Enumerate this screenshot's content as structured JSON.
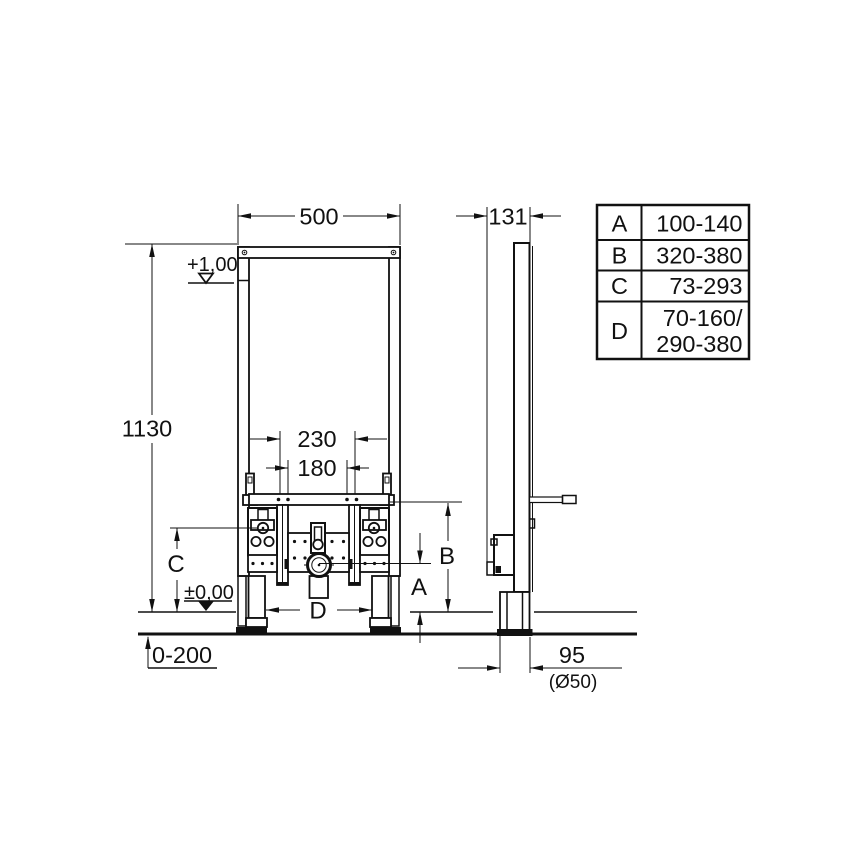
{
  "drawing": {
    "front_view": {
      "width_dim": "500",
      "height_dim": "1130",
      "bolt_spacing_outer": "230",
      "bolt_spacing_inner": "180",
      "level_upper": "+1,00",
      "level_floor": "±0,00",
      "floor_buildup_range": "0-200",
      "dim_a_label": "A",
      "dim_b_label": "B",
      "dim_c_label": "C",
      "dim_d_label": "D"
    },
    "side_view": {
      "depth_dim": "131",
      "drain_offset": "95",
      "drain_diameter_note": "(Ø50)"
    },
    "spec_table": {
      "rows": [
        {
          "label": "A",
          "range": "100-140"
        },
        {
          "label": "B",
          "range": "320-380"
        },
        {
          "label": "C",
          "range": "73-293"
        },
        {
          "label": "D",
          "range_line1": "70-160/",
          "range_line2": "290-380"
        }
      ]
    }
  }
}
